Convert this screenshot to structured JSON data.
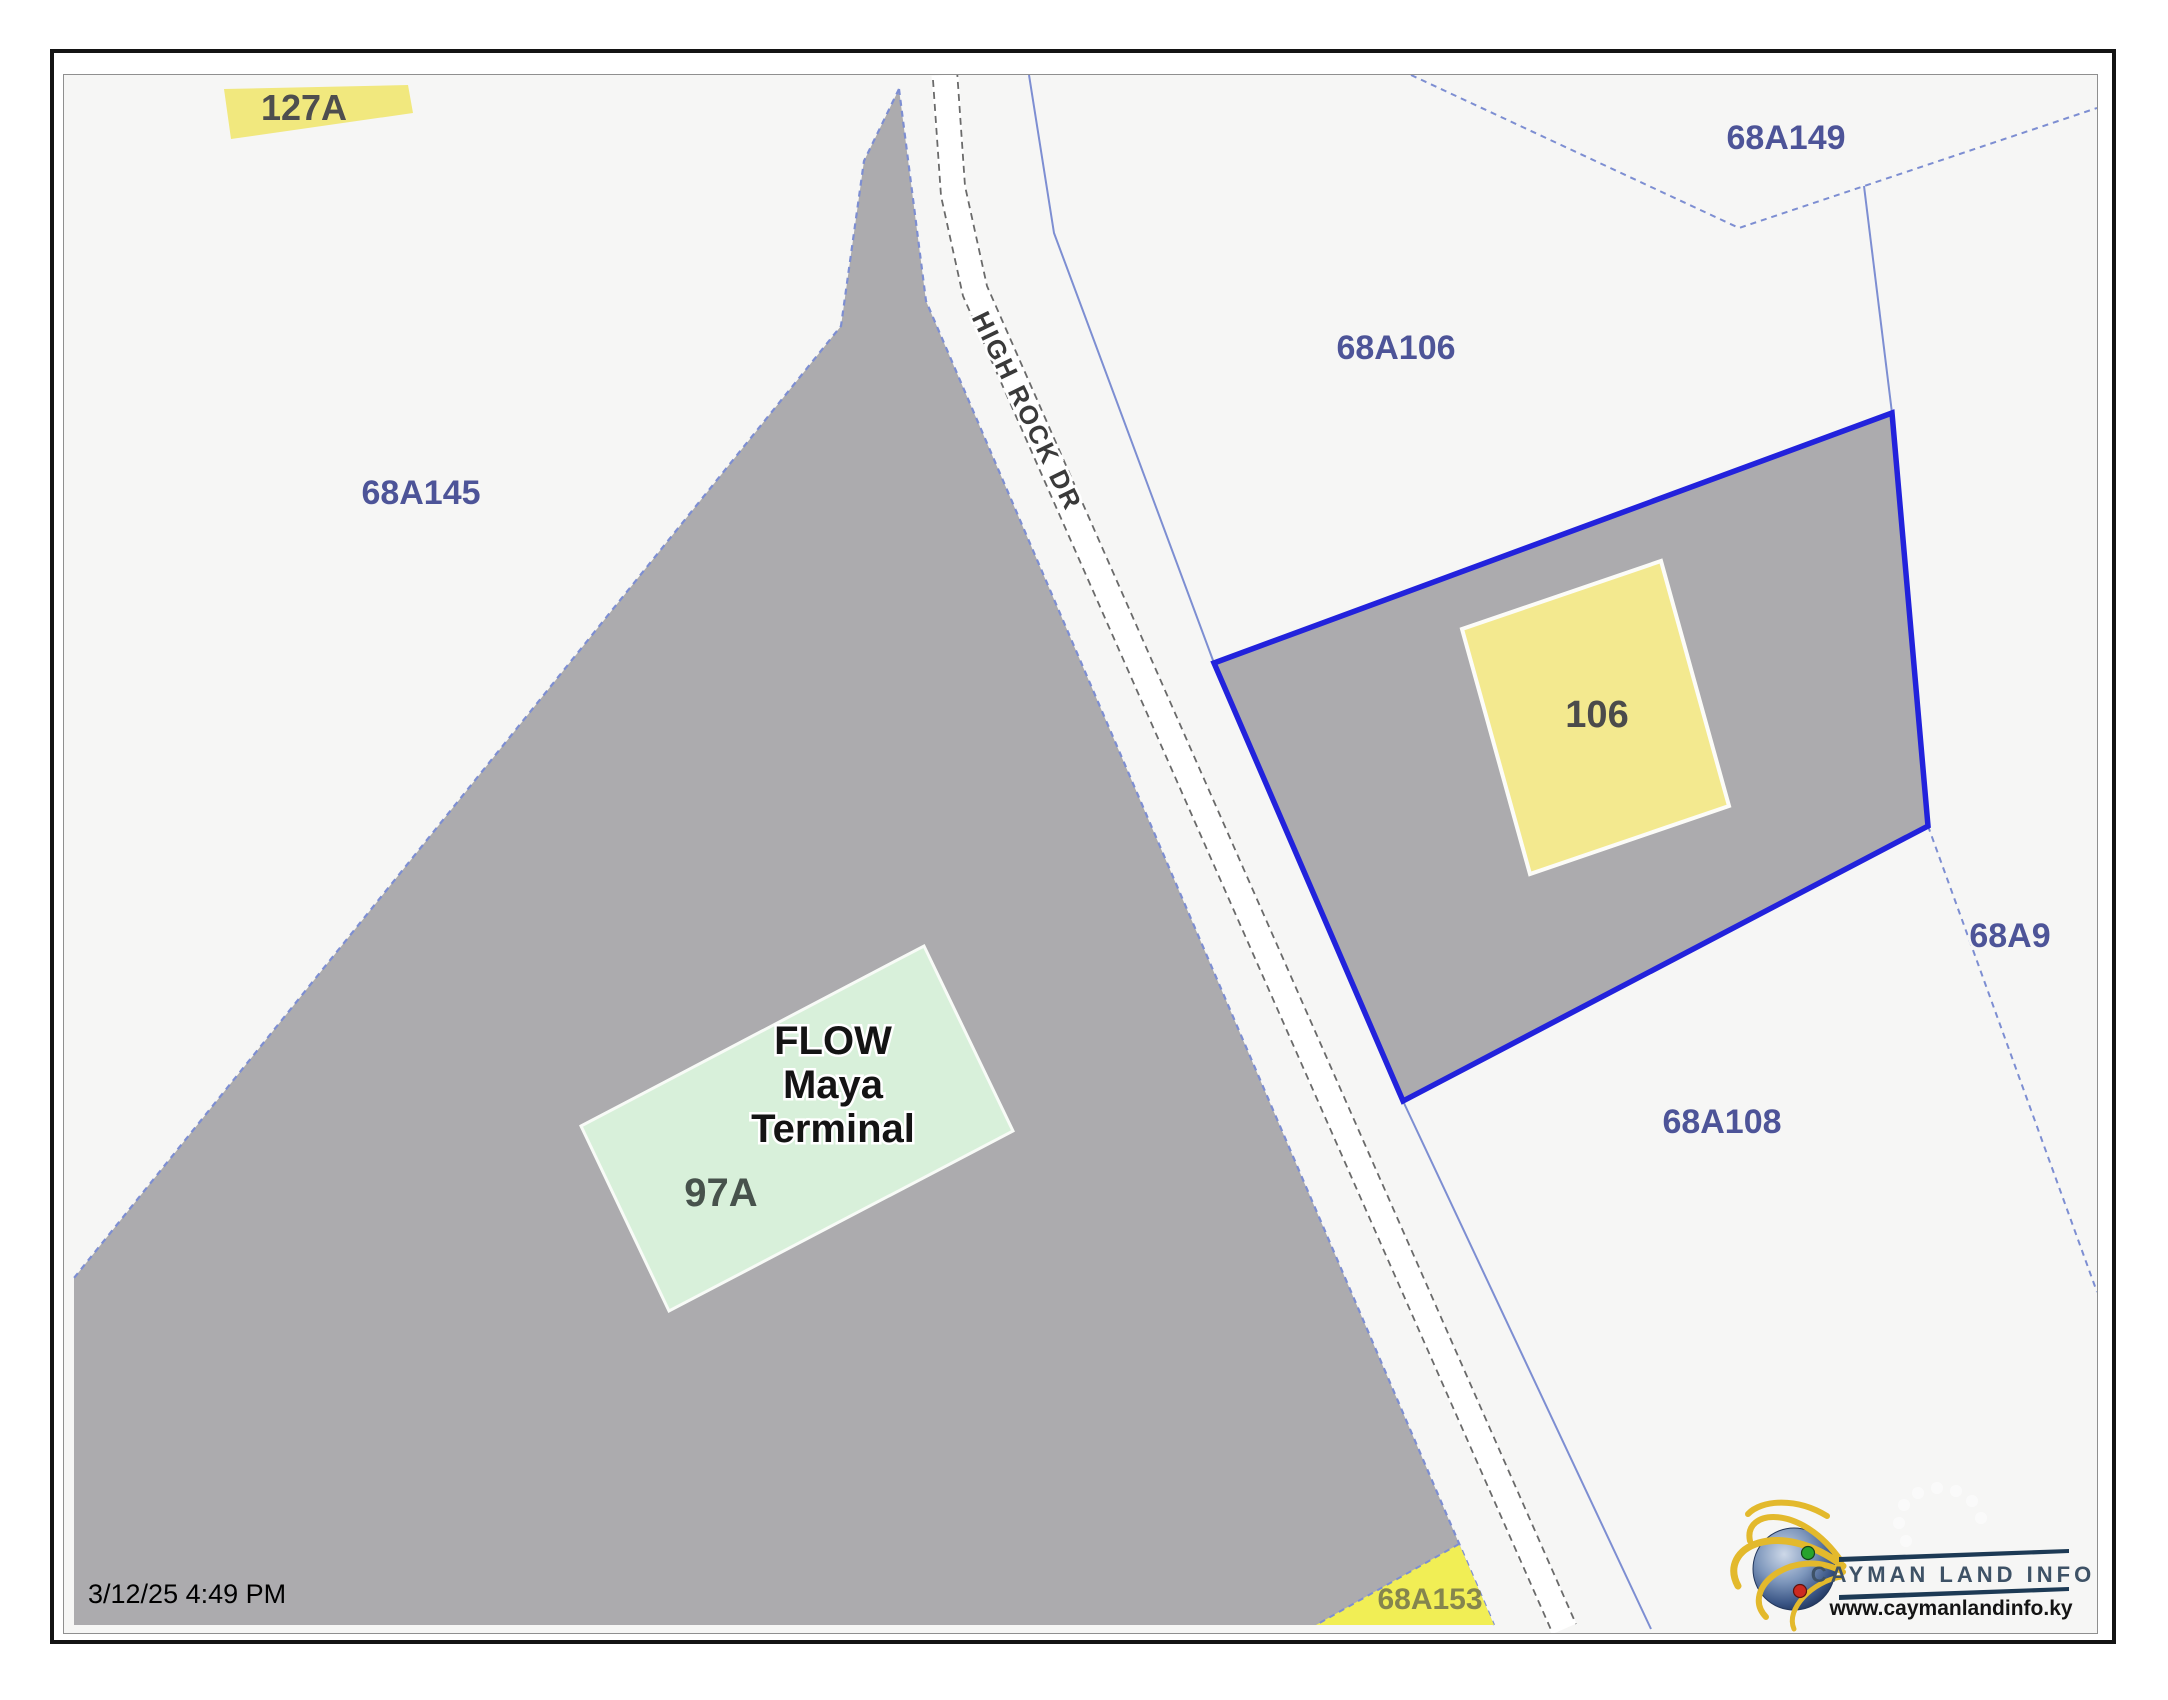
{
  "map": {
    "timestamp": "3/12/25 4:49 PM",
    "road": {
      "name": "HIGH ROCK DR"
    },
    "parcels": {
      "p127A": "127A",
      "p68A149": "68A149",
      "p68A106": "68A106",
      "p68A145": "68A145",
      "p68A9": "68A9",
      "p68A108": "68A108",
      "p68A153": "68A153",
      "selected_building": "106",
      "flow_terminal": {
        "line1": "FLOW",
        "line2": "Maya",
        "line3": "Terminal",
        "parcel": "97A"
      }
    }
  },
  "logo": {
    "title": "CAYMAN LAND INFO",
    "website": "www.caymanlandinfo.ky"
  },
  "colors": {
    "selected_parcel_outline": "#2222dc",
    "parcel_gray_fill": "#acabae",
    "building_yellow": "#f3e98f",
    "building_green": "#d8f0da",
    "highlight_yellow_127A": "#f1e87e",
    "highlight_yellow_153": "#f1ee55",
    "parcel_label_blue": "#4d5498",
    "boundary_blue": "#7d8ed2",
    "logo_line_navy": "#1d3a55"
  }
}
